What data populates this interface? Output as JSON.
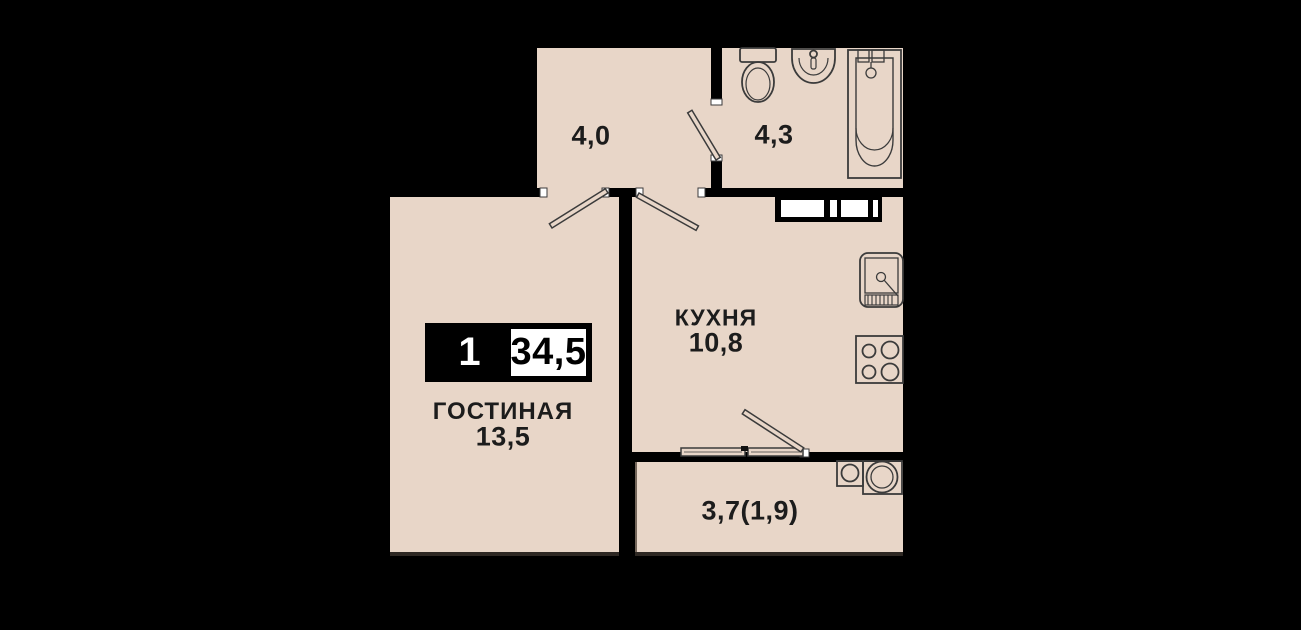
{
  "floor_plan": {
    "badge": {
      "room_count": "1",
      "total_area": "34,5"
    },
    "rooms": {
      "hallway": {
        "area": "4,0"
      },
      "bathroom": {
        "area": "4,3"
      },
      "kitchen": {
        "name": "КУХНЯ",
        "area": "10,8"
      },
      "living": {
        "name": "ГОСТИНАЯ",
        "area": "13,5"
      },
      "balcony": {
        "area": "3,7(1,9)"
      }
    },
    "fixtures": [
      "toilet-icon",
      "bathroom-sink-icon",
      "bathtub-icon",
      "vent-shaft",
      "kitchen-sink-icon",
      "stove-icon",
      "washing-machine-icon",
      "washing-machine-large-icon",
      "door-swing-living",
      "door-swing-kitchen",
      "door-swing-bathroom",
      "balcony-window",
      "balcony-door-swing"
    ],
    "colors": {
      "background": "#000000",
      "floor": "#e8d6c8",
      "walls": "#000000",
      "fixture_lines": "#3b3b3b",
      "text": "#1c1c1c",
      "badge_black": "#000000",
      "badge_white": "#ffffff"
    }
  }
}
